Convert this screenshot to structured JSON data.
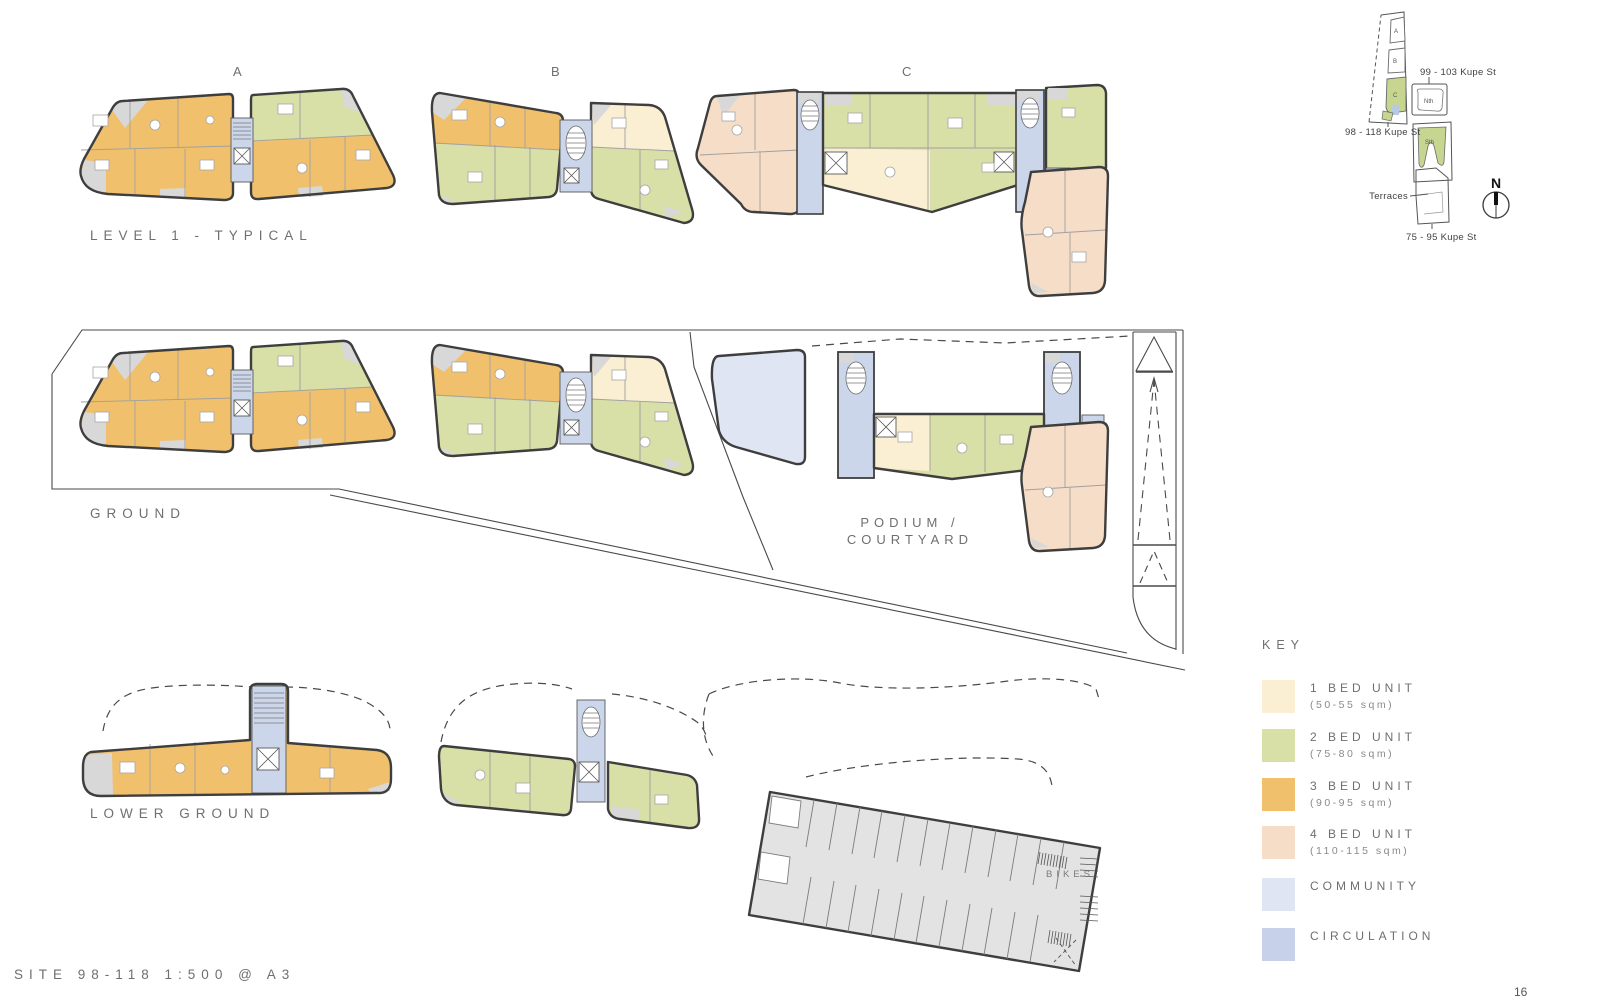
{
  "page": {
    "footer_left": "SITE 98-118 1:500 @ A3",
    "page_number": "16"
  },
  "sections": {
    "level1": {
      "title": "LEVEL 1 - TYPICAL",
      "building_a": "A",
      "building_b": "B",
      "building_c": "C"
    },
    "ground": {
      "title": "GROUND",
      "podium_line1": "PODIUM /",
      "podium_line2": "COURTYARD"
    },
    "lower_ground": {
      "title": "LOWER GROUND",
      "bikes": "BIKES"
    }
  },
  "key": {
    "title": "KEY",
    "items": [
      {
        "label": "1 BED UNIT",
        "sublabel": "(50-55 sqm)",
        "color": "#faeed3"
      },
      {
        "label": "2 BED UNIT",
        "sublabel": "(75-80 sqm)",
        "color": "#d8dfa7"
      },
      {
        "label": "3 BED UNIT",
        "sublabel": "(90-95 sqm)",
        "color": "#f0c06d"
      },
      {
        "label": "4 BED UNIT",
        "sublabel": "(110-115 sqm)",
        "color": "#f6ddc7"
      },
      {
        "label": "COMMUNITY",
        "sublabel": "",
        "color": "#dfe5f3"
      },
      {
        "label": "CIRCULATION",
        "sublabel": "",
        "color": "#c7d1ea"
      }
    ]
  },
  "sitemap": {
    "north_site_label": "99 - 103 Kupe St",
    "site_label": "98 - 118 Kupe St",
    "south_site_label": "75 - 95 Kupe St",
    "terraces_label": "Terraces",
    "north_building": "Nth",
    "south_building": "Sth",
    "building_a": "A",
    "building_b": "B",
    "building_c": "C",
    "north_arrow": "N"
  }
}
